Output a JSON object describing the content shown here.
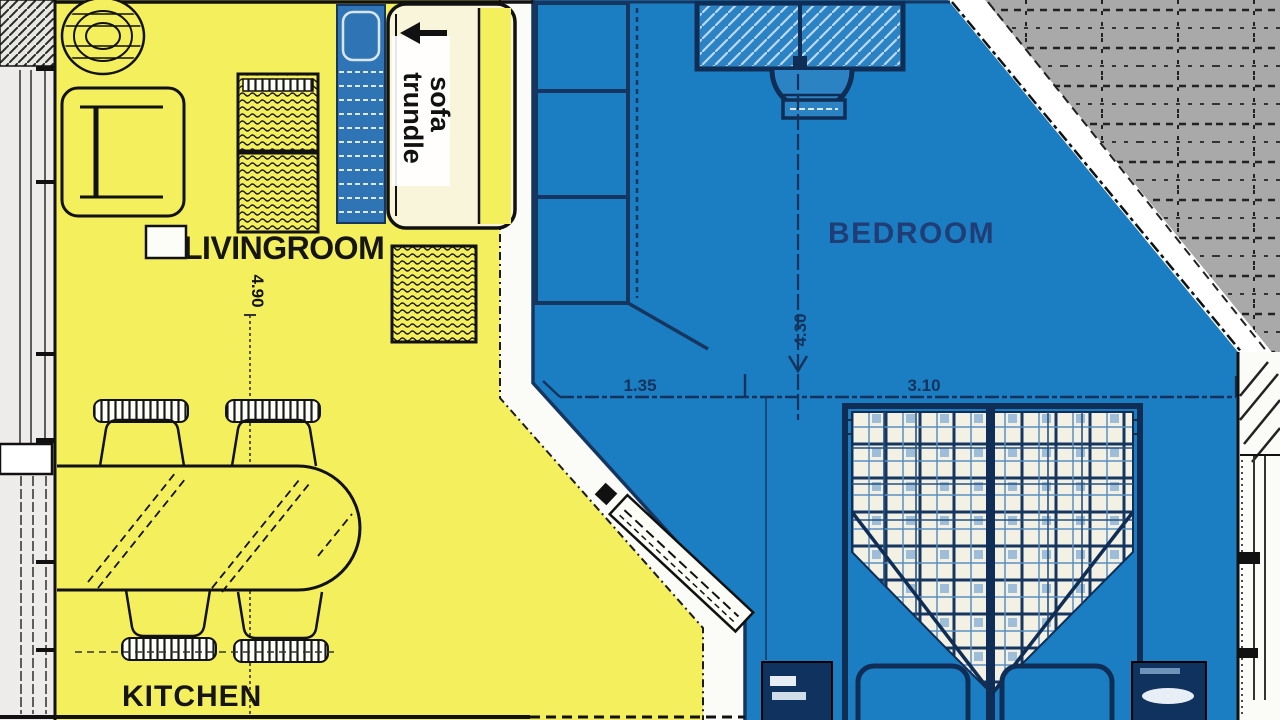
{
  "floorplan": {
    "rooms": {
      "livingroom": {
        "label": "LIVINGROOM"
      },
      "bedroom": {
        "label": "BEDROOM"
      },
      "kitchen": {
        "label": "KITCHEN"
      }
    },
    "annotation": {
      "sofa_word": "sofa",
      "trundle_word": "trundle",
      "arrow_icon": "left-arrow"
    },
    "dimensions": {
      "livingroom_depth": "4.90",
      "bedroom_segment_left": "1.35",
      "bedroom_segment_right": "3.10",
      "bedroom_depth": "4.30"
    },
    "colors": {
      "livingroom_fill": "#f4ef5c",
      "bedroom_fill": "#1b7ec2",
      "roof_fill": "#a9a9a9",
      "wall_fill": "#fbfbf7",
      "furniture_line": "#0f2d55"
    }
  }
}
